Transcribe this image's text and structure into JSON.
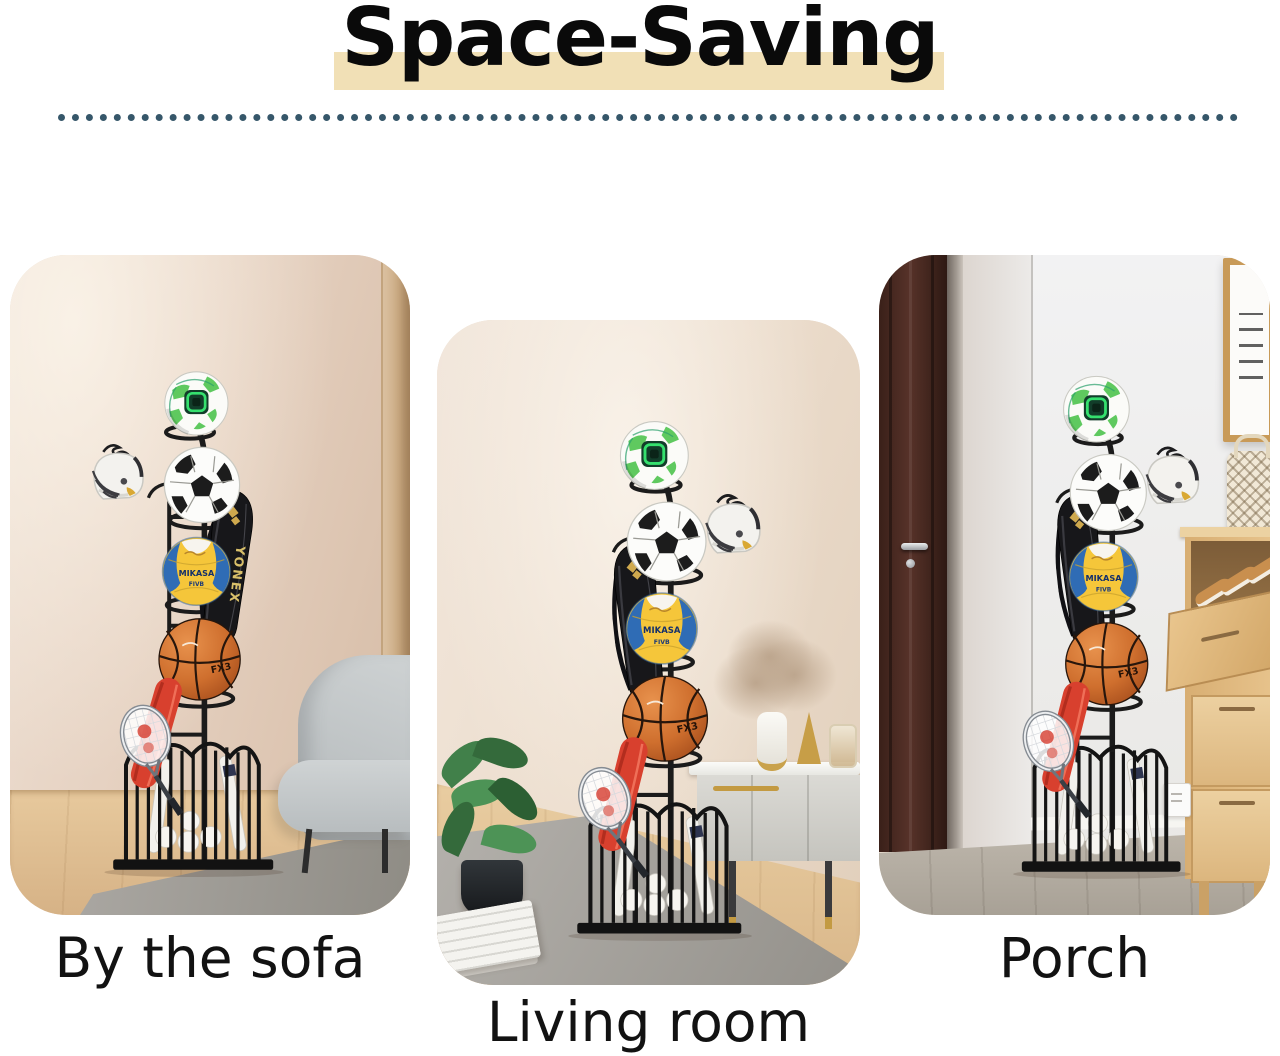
{
  "title": {
    "text": "Space-Saving"
  },
  "styles": {
    "title_color": "#0a0a0a",
    "highlight_color": "#f1e0b6",
    "divider_dot_color": "#26495e",
    "caption_color": "#121212"
  },
  "cards": [
    {
      "id": "by-the-sofa",
      "caption": "By the sofa",
      "scene": [
        "beige wall",
        "wall molding",
        "wood floor",
        "gray area rug",
        "gray sofa",
        "sports equipment rack"
      ]
    },
    {
      "id": "living-room",
      "caption": "Living room",
      "scene": [
        "beige wall",
        "wood floor",
        "gray area rug",
        "potted plant",
        "white sideboard with gold legs",
        "dried-flower vase decor",
        "newspaper",
        "sports equipment rack"
      ]
    },
    {
      "id": "porch",
      "caption": "Porch",
      "scene": [
        "dark wooden door",
        "white wall",
        "picture frame",
        "rattan bag",
        "wooden shoe cabinet with shoes",
        "wall outlet",
        "gray wood floor",
        "sports equipment rack"
      ]
    }
  ],
  "rack": {
    "items": [
      "green-white soccer ball",
      "football helmet",
      "black racket bag",
      "soccer ball",
      "volleyball",
      "basketball",
      "red racket cover",
      "badminton racket",
      "wire storage basket",
      "baseball bats",
      "baseballs"
    ],
    "bag_brand": "YONEX",
    "volleyball_brand": "MIKASA",
    "volleyball_sub": "FIVB",
    "basketball_brand": "FX3"
  }
}
